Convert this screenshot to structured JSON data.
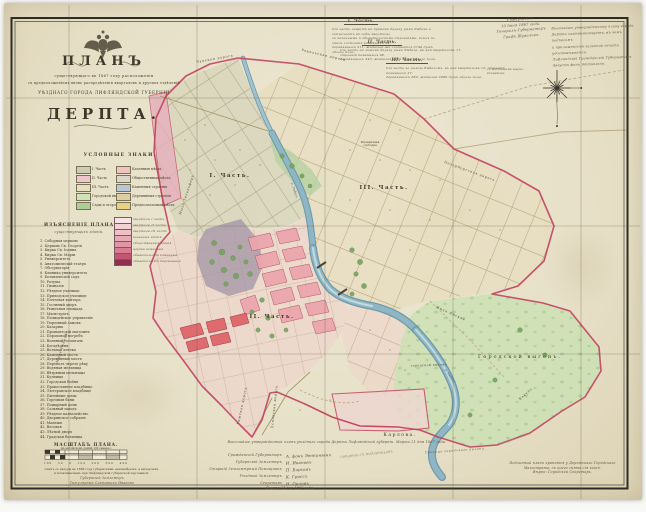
{
  "title_block": {
    "plan": "ПЛАНЪ",
    "line1": "существующаго въ 1867 году расположенія",
    "line2": "съ предположеніемъ вновь распредѣленія кварталовъ и другихъ отдѣленій",
    "line3": "УѢЗДНАГО ГОРОДА ЛИФЛЯНДСКОЙ ГУБЕРНІИ",
    "city": "ДЕРПТА."
  },
  "legend": {
    "header": "УСЛОВНЫЕ ЗНАКИ.",
    "left": [
      {
        "label": "I. Часть",
        "color": "#cdccb2"
      },
      {
        "label": "II. Часть",
        "color": "#eec5c9"
      },
      {
        "label": "III. Часть",
        "color": "#e8dec0"
      },
      {
        "label": "Городской выгонъ",
        "color": "#cfe2b8"
      },
      {
        "label": "Сады и огороды",
        "color": "#a9ce96"
      }
    ],
    "right": [
      {
        "label": "Казенныя мѣста",
        "color": "#f0c2c2"
      },
      {
        "label": "Общественныя мѣста",
        "color": "#dcd6c8"
      },
      {
        "label": "Каменныя строенія",
        "color": "#b9c6d8"
      },
      {
        "label": "Деревянныя строенія",
        "color": "#dfcda2"
      },
      {
        "label": "Предполагаемыя мѣста",
        "color": "#e9d184"
      }
    ]
  },
  "explanation": {
    "header": "ИЗЪЯСНЕНІЕ ПЛАНА",
    "subheader": "существующихъ зданій.",
    "items": [
      "1. Соборная церковь",
      "2. Церковь Св. Георгія",
      "3. Кирка Св. Іоанна",
      "4. Кирка Св. Маріи",
      "5. Университетъ",
      "6. Анатомическій театръ",
      "7. Обсерваторія",
      "8. Клиника университета",
      "9. Ботаническій садъ",
      "10. Ратуша",
      "11. Гимназія",
      "12. Уѣздное училище",
      "13. Приходское училище",
      "14. Почтовая контора",
      "15. Гостиный дворъ",
      "16. Рыночная площадь",
      "17. Магистратъ",
      "18. Полицейское управленіе",
      "19. Тюремный замокъ",
      "20. Казармы",
      "21. Провіантскій магазинъ",
      "22. Пороховой погребъ",
      "23. Военный госпиталь",
      "24. Богадѣльня",
      "25. Вольная аптека",
      "26. Каменный мостъ",
      "27. Деревянный мостъ",
      "28. Перевозъ черезъ рѣку",
      "29. Водяная мельница",
      "30. Вѣтряныя мельницы",
      "31. Кузницы",
      "32. Городская бойня",
      "33. Православное кладбище",
      "34. Лютеранское кладбище",
      "35. Питейные домы",
      "36. Торговыя бани",
      "37. Пожарный домъ",
      "38. Сальный заводъ",
      "39. Уѣздное казначейство",
      "40. Дворянское собраніе",
      "41. Манежъ",
      "42. Весовая",
      "43. Лѣсной дворъ",
      "44. Градская больница"
    ],
    "swatches": [
      {
        "color": "#f7e3e4",
        "label": "кварталы I части"
      },
      {
        "color": "#f3d2d6",
        "label": "кварталы II части"
      },
      {
        "color": "#efc0c8",
        "label": "кварталы III части"
      },
      {
        "color": "#e9aab8",
        "label": "казенныя зданія"
      },
      {
        "color": "#e395a8",
        "label": "общественныя зданія"
      },
      {
        "color": "#d87b93",
        "label": "церкви каменныя"
      },
      {
        "color": "#c25672",
        "label": "обывательскія каменныя"
      },
      {
        "color": "#8e3050",
        "label": "обывательскія деревянныя"
      }
    ]
  },
  "parts_notes": [
    {
      "header": "I. Часть.",
      "lines": [
        "Сія часть лежитъ на правомъ берегу рѣки Эмбаха и заключаетъ въ себѣ кварталы",
        "съ казенными и обывательскими строеніями, коихъ по описи состоитъ каменныхъ 64,",
        "деревянныхъ 211, жителей же считается 3740 душъ обоего пола."
      ]
    },
    {
      "header": "II. Часть.",
      "lines": [
        "Сія часть на лѣвомъ берегу рѣки Эмбаха, въ ней кварталовъ 17, строеній каменныхъ 98,",
        "деревянныхъ 343, жителей 4120 душъ обоего пола."
      ]
    },
    {
      "header": "III. Часть.",
      "lines": [
        "Сія часть за рѣкою Эмбахомъ, въ ней кварталовъ 12, строеній каменныхъ 27,",
        "деревянныхъ 280, жителей 2980 душъ обоего пола."
      ]
    }
  ],
  "corner_notes": {
    "left_lines": [
      "Утверждаю.",
      "10 Іюня 1867 года.",
      "Генералъ-Губернаторъ",
      "Графъ Шуваловъ."
    ],
    "right_lines": [
      "Высочайше утвержденному плану города",
      "Дерпта соотвѣтствуетъ, въ чемъ подписомъ",
      "и приложеніемъ казенной печати",
      "удостовѣряется.",
      "Лифляндскій Гражданскій Губернаторъ",
      "Августъ фонъ Эттингенъ."
    ],
    "small_lines": [
      "съ подлиннымъ вѣрно:",
      "Секретарь"
    ]
  },
  "map_labels": {
    "part1": "I. Часть.",
    "part2": "II. Часть.",
    "part3": "III. Часть.",
    "vygon": "Городской выгонъ.",
    "vygon_small": "городской выгонъ",
    "karlova": "Карлова.",
    "sloboda_lines": [
      "Мельничная",
      "слободка"
    ],
    "granitsa": "Граница городскаго выгона.",
    "river_1": "р. Эмбахъ",
    "river_2": "р. Эмбахъ",
    "roads": [
      {
        "text": "Чудская дорога"
      },
      {
        "text": "Ревельская дорога"
      },
      {
        "text": "Петербургская дорога"
      },
      {
        "text": "Мыза Техельферъ"
      },
      {
        "text": "Рижская дорога"
      },
      {
        "text": "Псковская дорога"
      },
      {
        "text": "Мыза Ямская"
      },
      {
        "text": "Вакула"
      },
      {
        "text": "Мыза Ропкой"
      }
    ]
  },
  "scale_block": {
    "title": "МАСШТАБЪ ПЛАНА.",
    "subtitle": "(въ англійскомъ дюймѣ 100 саженъ.)",
    "numbers": "100   50   0   100   200   300   400",
    "note_lines": [
      "Снятъ съ натуры въ 1866 году губернскимъ землемѣромъ, а вычерченъ",
      "и иллюминованъ при Лифляндской губернской чертежной."
    ],
    "sig_lines": [
      "Губернскій Землемѣръ",
      "Титулярный Совѣтникъ Ивановъ"
    ]
  },
  "signatures": {
    "long_note": "Высочайше утвержденный планъ уѣзднаго города Дерпта Лифляндской губерніи. Марта 21 дня 1867 года.",
    "rows": [
      {
        "role": "Гражданскій Губернаторъ",
        "sign": "А. фонъ Эттингенъ"
      },
      {
        "role": "Губернскій Землемѣръ",
        "sign": "И. Ивановъ"
      },
      {
        "role": "Старшій Землемѣрный Помощникъ",
        "sign": "П. Барсовъ"
      },
      {
        "role": "Уѣздный Землемѣръ",
        "sign": "К. Гроссъ"
      },
      {
        "role": "Секретарь",
        "sign": "Н. Орловъ"
      }
    ],
    "date": "Января 14 дня 1867 года."
  },
  "bottom_right_note": {
    "lines": [
      "Подлинный планъ хранится у Дерптскаго Городскаго",
      "Магистрата, съ коего снята сія копія.",
      "Вѣрно: Городской Секретарь."
    ]
  },
  "annotations": {
    "pencil_a": "свѣрено съ подлиннымъ",
    "pencil_b": "повѣрено 1885 г."
  },
  "colors": {
    "boundary_red": "#c2425e",
    "river_blue": "#8fb6c4",
    "pasture_green": "#cce0b4",
    "sheet_parchment": "#e9e2cb"
  }
}
